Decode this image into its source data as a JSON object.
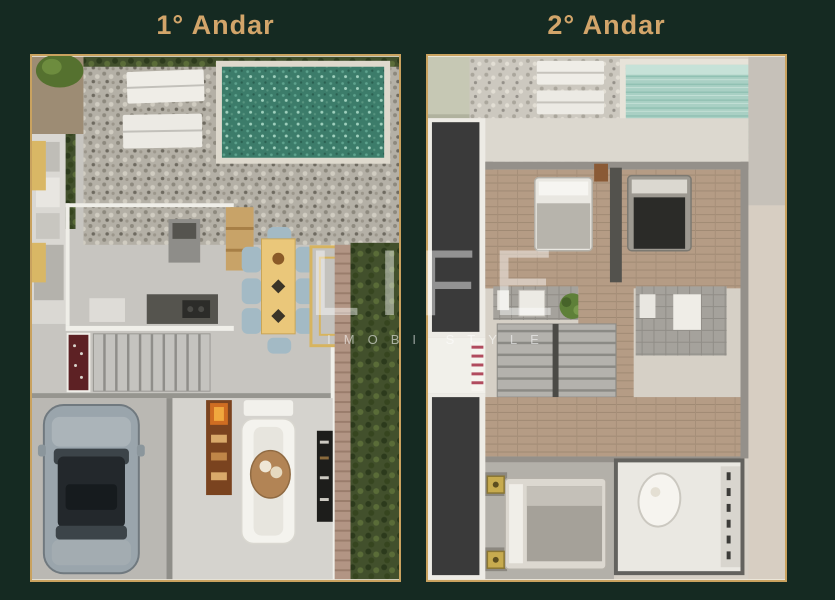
{
  "theme": {
    "background": "#152a22",
    "title_gold": "#d2a56a",
    "frame_gold": "#c9a25f",
    "watermark_color": "rgba(255,255,255,0.45)",
    "watermark_sub_color": "rgba(255,255,255,0.55)"
  },
  "header": {
    "floor1_title": "1° Andar",
    "floor2_title": "2° Andar"
  },
  "watermark": {
    "brand": "LIFE",
    "tagline": "IMOBI STYLE"
  },
  "colors": {
    "pool_floor1_water": "#3c7c6a",
    "pool_floor2_water": "#a9d0c4",
    "dining_table": "#eac77a",
    "wine_cellar": "#5d2124",
    "car_body": "#9aa5ac",
    "void_dark": "#3a3a3a",
    "hedge_green": "#42502c"
  },
  "plans": [
    {
      "id": "floor-1",
      "label": "1° Andar",
      "features": [
        "hedge",
        "stone-deck",
        "swimming-pool",
        "sun-loungers",
        "wood-deck",
        "outdoor-kitchen",
        "bbq-area",
        "dining-table",
        "dining-chairs",
        "outdoor-rug",
        "kitchen-island",
        "staircase",
        "wine-cellar",
        "garage",
        "car",
        "fireplace-shelf",
        "sofa",
        "round-rug",
        "tv-panel",
        "brick-walkway"
      ]
    },
    {
      "id": "floor-2",
      "label": "2° Andar",
      "features": [
        "roof-deck",
        "gravel-deck",
        "swimming-pool",
        "sun-loungers",
        "double-height-void",
        "bedroom-suite-left",
        "bedroom-suite-right",
        "wood-hallway",
        "bathrooms",
        "plant",
        "staircase",
        "red-rug",
        "master-bedroom",
        "bedside-lamps",
        "master-bathroom",
        "oval-bathtub",
        "closet"
      ]
    }
  ]
}
